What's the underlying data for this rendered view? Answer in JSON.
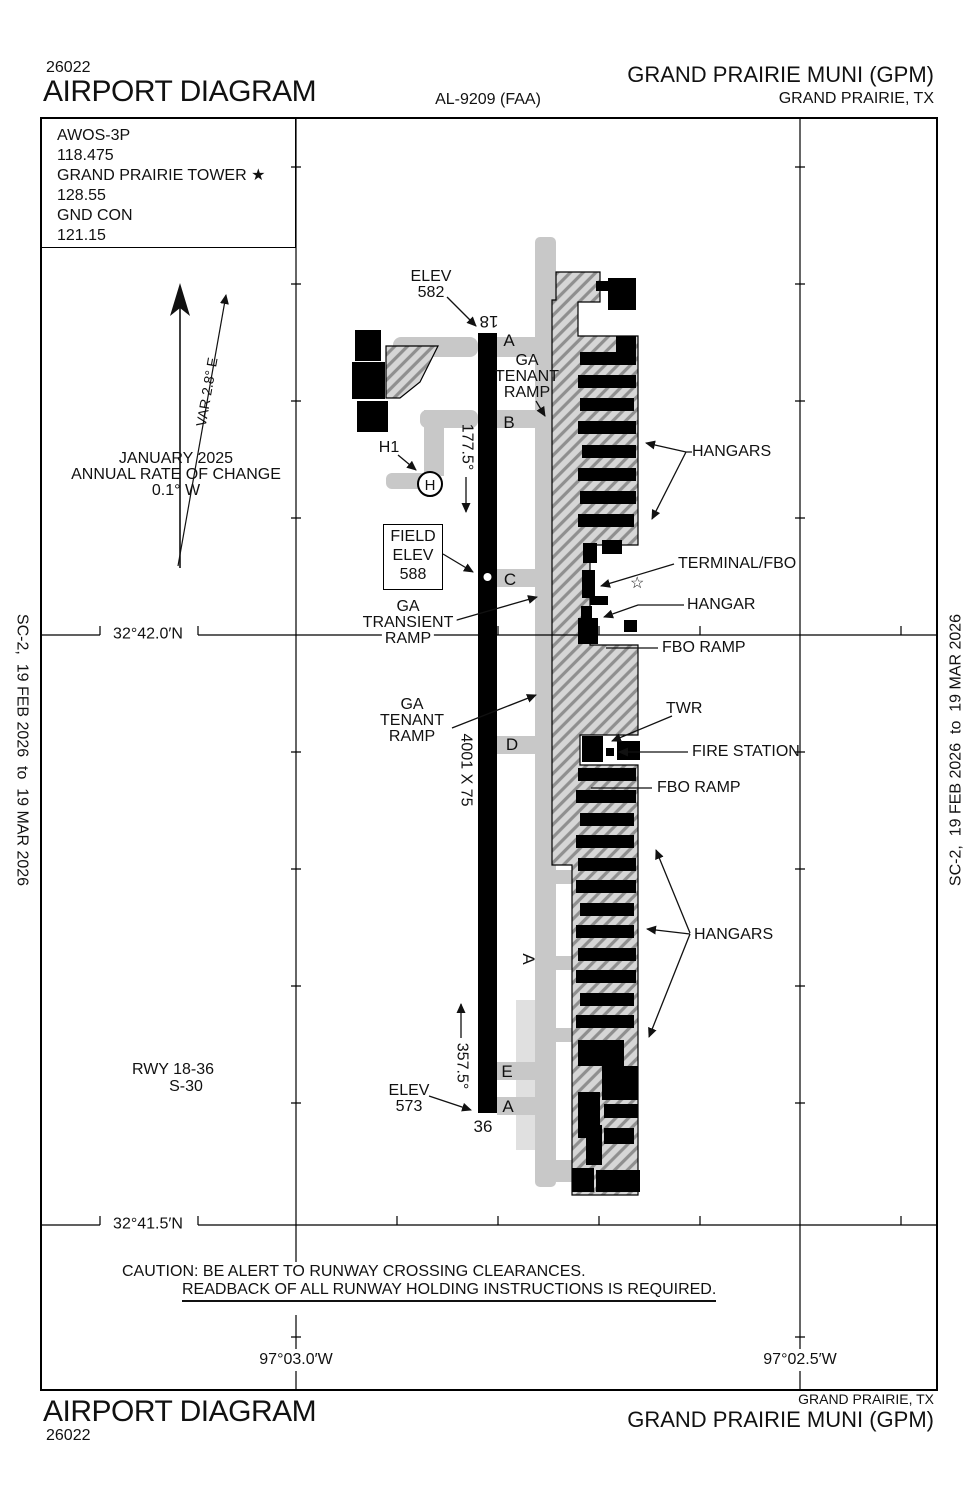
{
  "header": {
    "chart_number": "26022",
    "title": "AIRPORT DIAGRAM",
    "al_number": "AL-9209 (FAA)",
    "airport_name": "GRAND PRAIRIE MUNI (GPM)",
    "city": "GRAND PRAIRIE, TX"
  },
  "footer": {
    "title": "AIRPORT DIAGRAM",
    "chart_number": "26022",
    "airport_name": "GRAND PRAIRIE MUNI (GPM)",
    "city": "GRAND PRAIRIE, TX"
  },
  "edge_note": "SC-2,  19 FEB 2026  to  19 MAR 2026",
  "comm_box": {
    "lines": [
      "AWOS-3P",
      "118.475",
      "GRAND PRAIRIE TOWER ★",
      "128.55",
      "GND CON",
      "121.15"
    ]
  },
  "compass": {
    "variation": "VAR 2.8° E",
    "date": "JANUARY 2025",
    "rate_label": "ANNUAL RATE OF CHANGE",
    "rate_value": "0.1° W"
  },
  "runway": {
    "number_north": "18",
    "number_south": "36",
    "heading_south": "177.5°",
    "heading_north": "357.5°",
    "dimensions": "4001 X 75",
    "designation": "RWY 18-36",
    "pavement_class": "S-30",
    "elev_label": "ELEV",
    "elev_north": "582",
    "elev_south": "573"
  },
  "field_elev": {
    "lines": [
      "FIELD",
      "ELEV",
      "588"
    ]
  },
  "taxiways": {
    "a_north": "A",
    "b": "B",
    "c": "C",
    "d": "D",
    "e": "E",
    "a_south": "A",
    "a_mid": "A",
    "h1": "H1",
    "helipad": "H"
  },
  "ramps": {
    "ga_tenant_north": [
      "GA",
      "TENANT",
      "RAMP"
    ],
    "ga_transient": [
      "GA",
      "TRANSIENT",
      "RAMP"
    ],
    "ga_tenant_south": [
      "GA",
      "TENANT",
      "RAMP"
    ]
  },
  "callouts": {
    "hangars_north": "HANGARS",
    "terminal_fbo": "TERMINAL/FBO",
    "hangar": "HANGAR",
    "fbo_ramp_north": "FBO RAMP",
    "twr": "TWR",
    "fire_station": "FIRE STATION",
    "fbo_ramp_south": "FBO RAMP",
    "hangars_south": "HANGARS"
  },
  "coordinates": {
    "lat_north": "32°42.0′N",
    "lat_south": "32°41.5′N",
    "lon_west": "97°03.0′W",
    "lon_east": "97°02.5′W"
  },
  "caution": {
    "line1": "CAUTION: BE ALERT TO RUNWAY CROSSING CLEARANCES.",
    "line2": "READBACK OF ALL RUNWAY HOLDING INSTRUCTIONS IS REQUIRED."
  },
  "icons": {
    "flag_star": "☆"
  }
}
